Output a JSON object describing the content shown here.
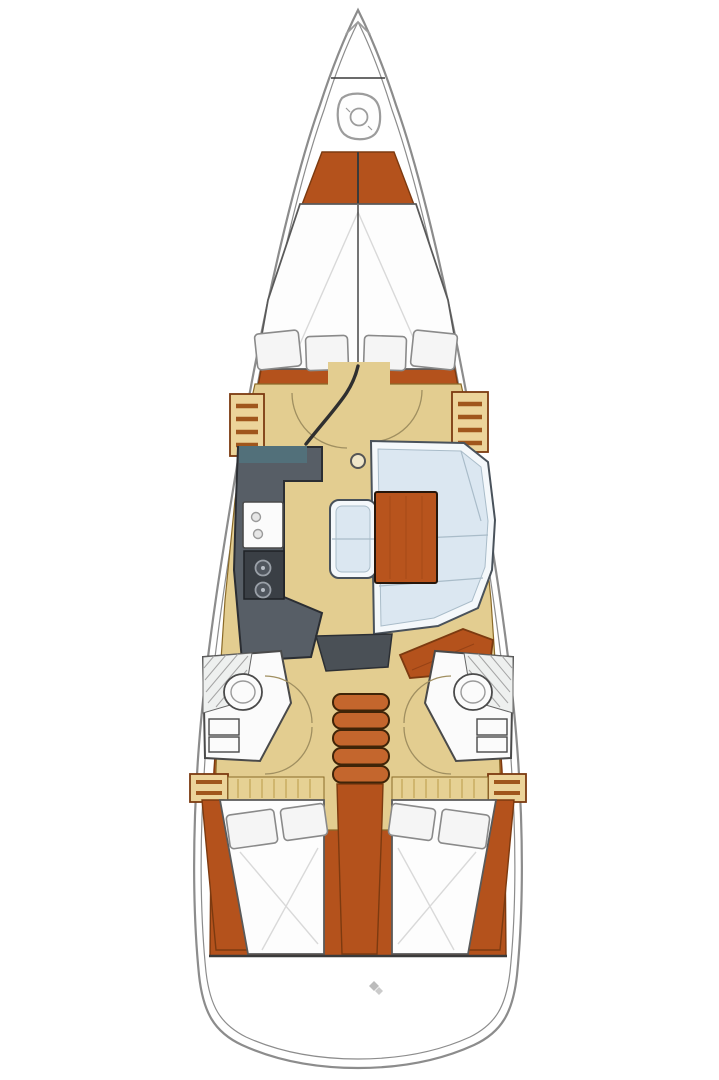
{
  "document": {
    "type": "sailboat-interior-floor-plan",
    "background": "#ffffff"
  },
  "colors": {
    "hull_line": "#8c8c8c",
    "line_dark": "#3a3a3a",
    "wood": "#b4521c",
    "wood_dark": "#7c3a10",
    "floor": "#e3cd90",
    "floor_edge": "#8a6a28",
    "bed": "#fdfdfd",
    "bed_line": "#5a5a5a",
    "pillow": "#f5f5f5",
    "pillow_line": "#8a8a8a",
    "settee": "#dbe7f1",
    "settee_trim": "#f4f8fb",
    "settee_line": "#49525b",
    "seam": "#a9bcc9",
    "table": "#b8541d",
    "galley": "#575e66",
    "galley_dark": "#2b2e33",
    "stove": "#3a3f45",
    "teal": "#52707a",
    "fixture": "#fbfbfb",
    "hatch": "#a5a5a5",
    "shelf": "#ecd49a",
    "shelf_stripe": "#a0561c",
    "step": "#c4662d",
    "arc": "#a08f60",
    "icon": "#9c9c9c",
    "quilt": "#d9d9d9"
  },
  "areas": {
    "hull": {
      "label": "sailboat hull outline"
    },
    "anchor_locker": {
      "label": "bow anchor locker with windlass"
    },
    "v_berth": {
      "label": "forward cabin V-berth with four pillows"
    },
    "forward_door": {
      "label": "forward cabin door with swing arcs"
    },
    "lockers_forward": {
      "label": "forward cabin shelved lockers"
    },
    "galley": {
      "label": "port galley with sink and two-burner stove"
    },
    "salon": {
      "label": "starboard salon settee with wooden table and bench"
    },
    "mast_post": {
      "label": "mast compression post"
    },
    "port_head": {
      "label": "port aft head with toilet and shower"
    },
    "starboard_head": {
      "label": "starboard aft head with toilet and shower"
    },
    "companionway": {
      "label": "companionway steps and engine box"
    },
    "port_aft_cabin": {
      "label": "port aft double berth"
    },
    "starboard_aft_cabin": {
      "label": "starboard aft double berth"
    },
    "transom": {
      "label": "stern transom platform"
    }
  },
  "icons": {
    "windlass": "windlass-icon",
    "stern_fitting": "stern-fitting-icon"
  }
}
